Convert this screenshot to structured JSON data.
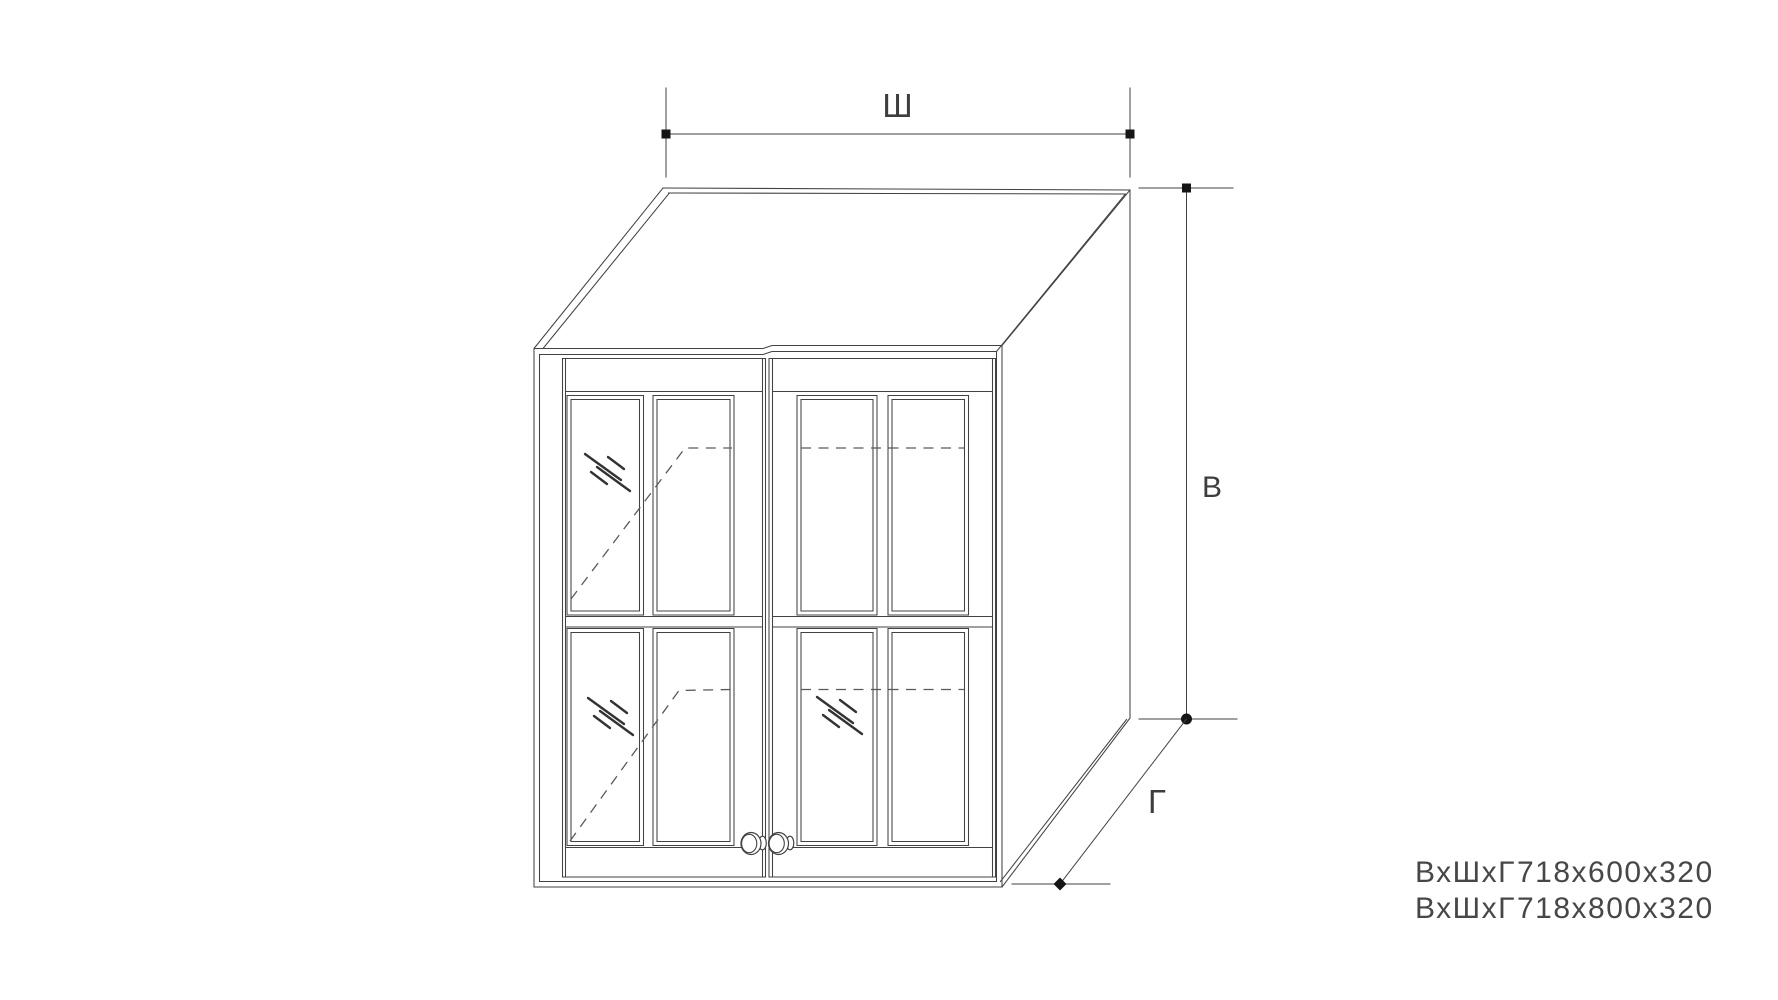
{
  "diagram": {
    "type": "technical-drawing",
    "subject": "wall-cabinet-with-two-glass-doors",
    "dimension_labels": {
      "width": "Ш",
      "height": "В",
      "depth": "Г"
    },
    "dimension_markers": {
      "width_line_ends": "square",
      "height_top": "square",
      "height_bottom": "circle",
      "depth_top": "circle",
      "depth_bottom": "diamond"
    },
    "specs": {
      "line1": {
        "prefix": "ВхШхГ",
        "value": "718х600х320"
      },
      "line2": {
        "prefix": "ВхШхГ",
        "value": "718х800х320"
      }
    }
  },
  "colors": {
    "line": "#424242",
    "dashed_line": "#5a5a5a",
    "glass_mark": "#333333",
    "marker": "#151515",
    "text": "#3d3d3d",
    "background": "#ffffff"
  }
}
